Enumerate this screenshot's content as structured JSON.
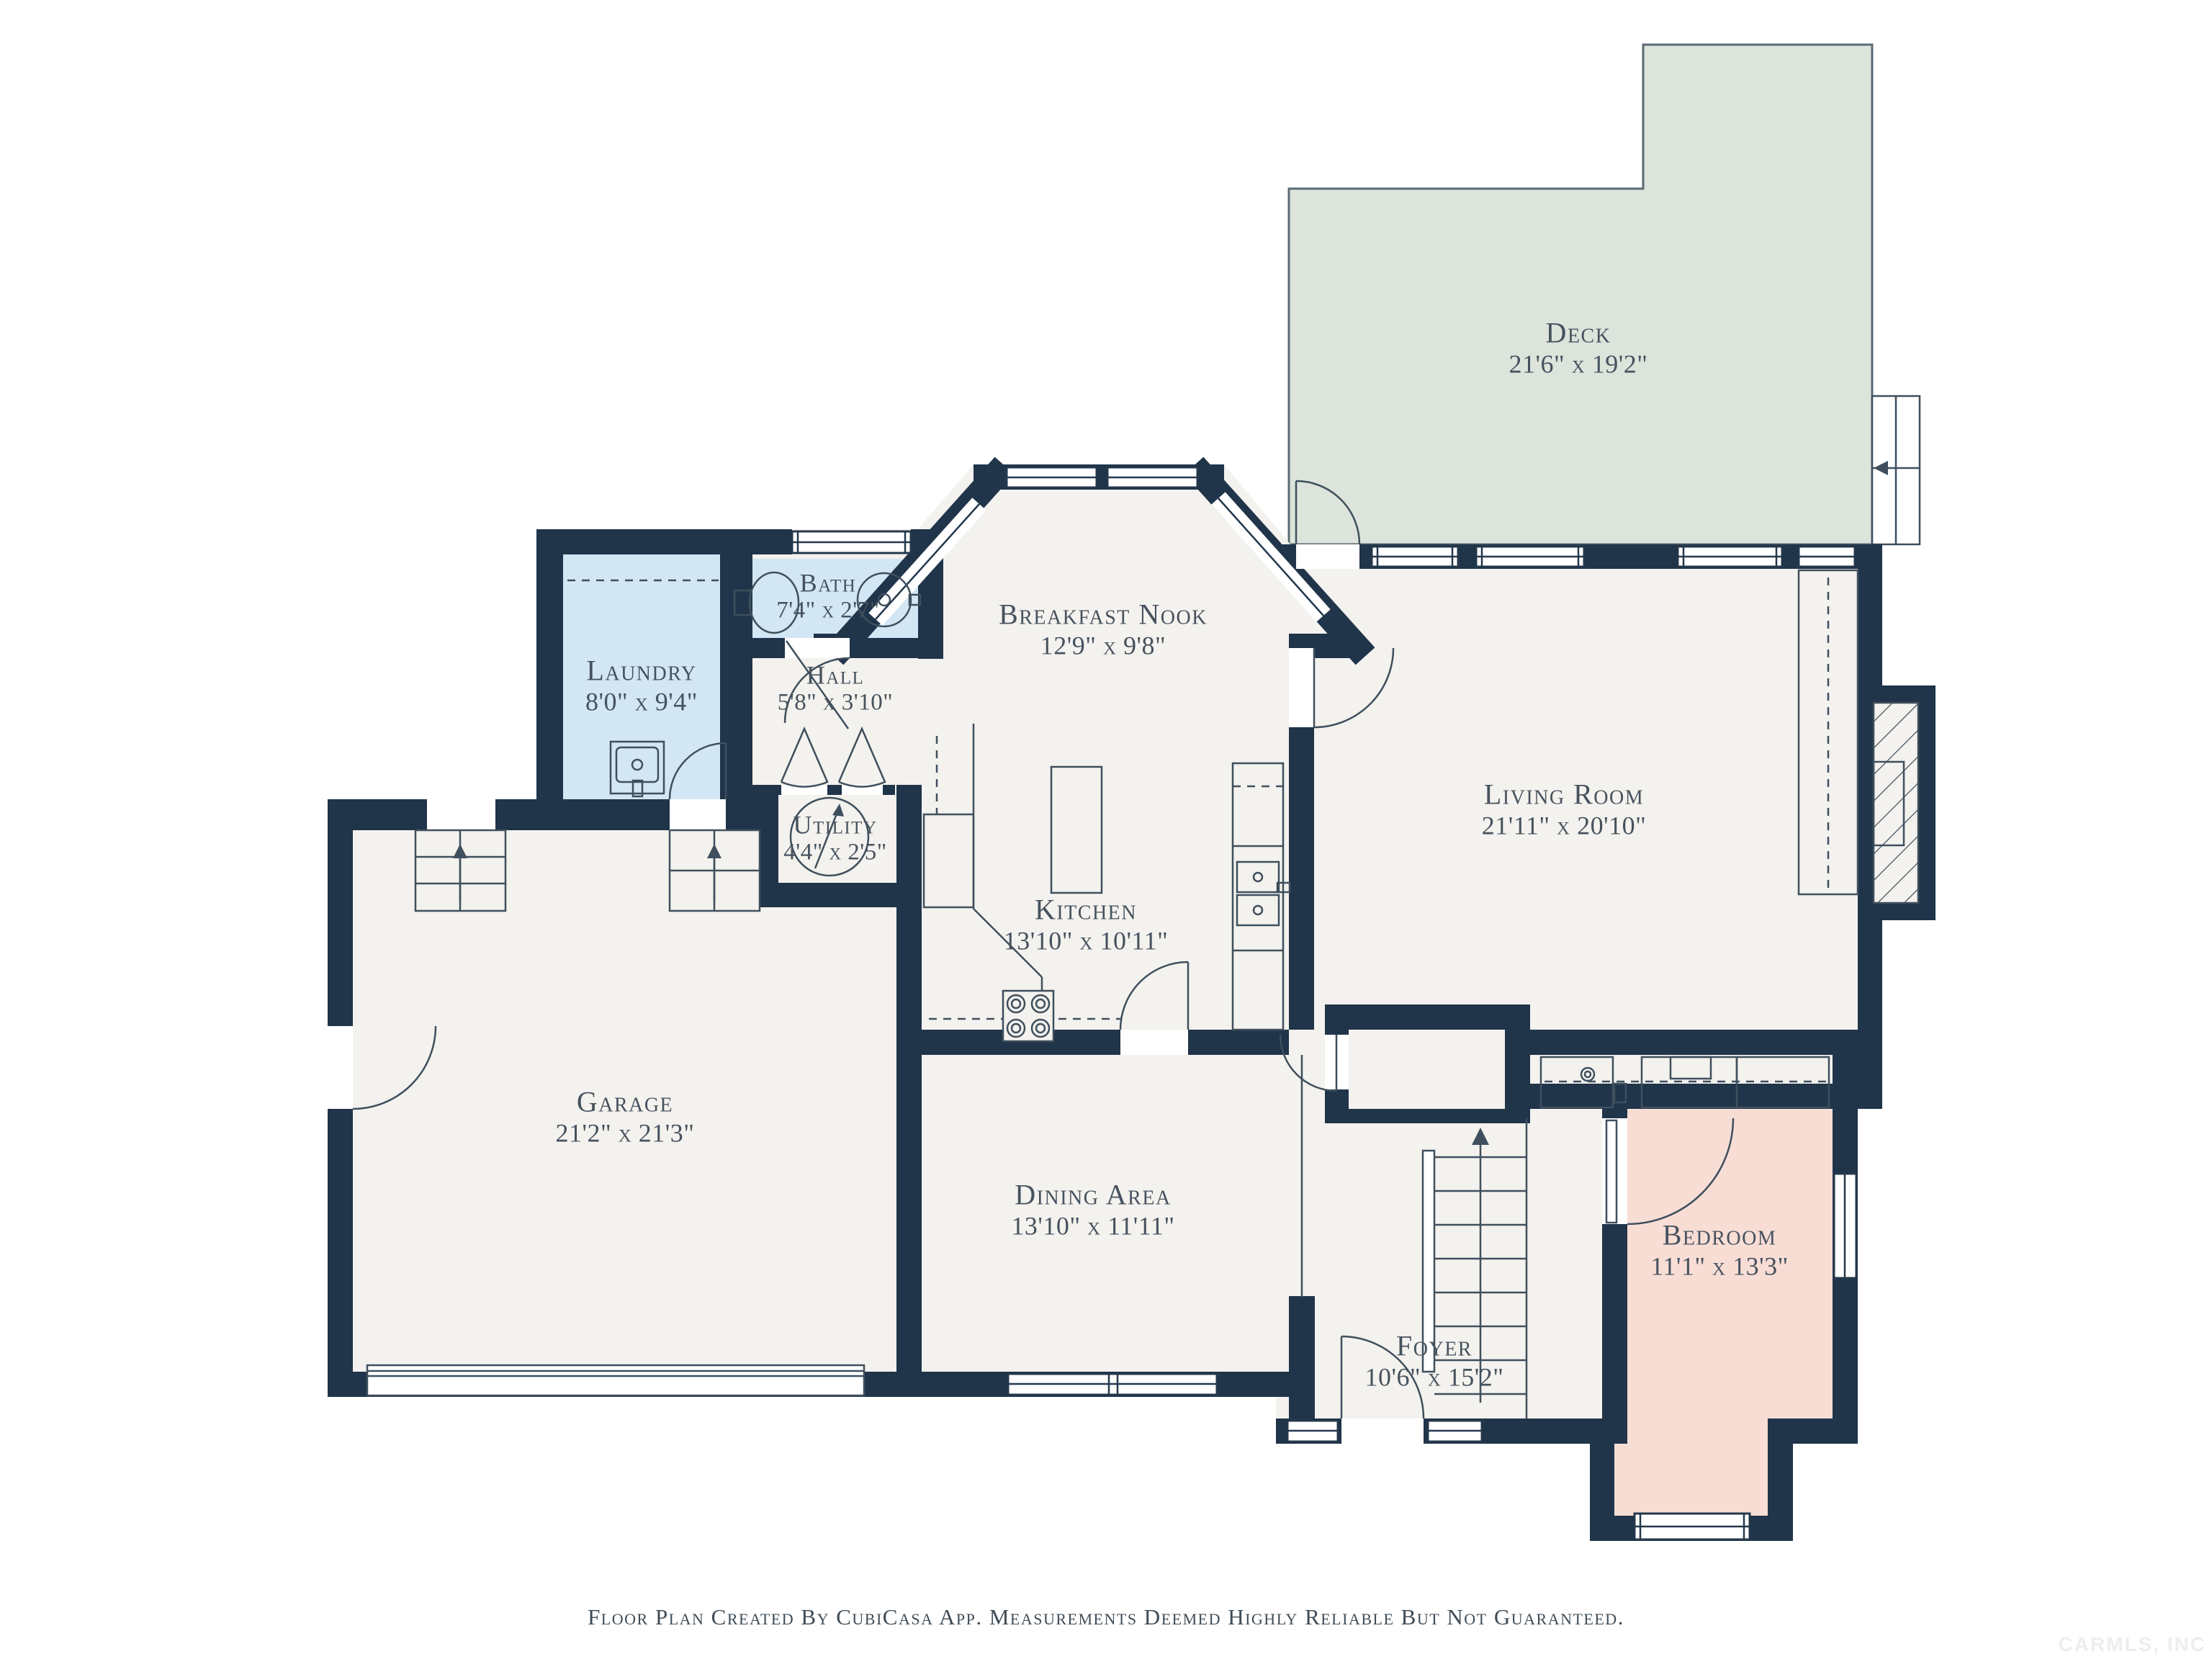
{
  "plan": {
    "source_note": "Floor Plan Created By CubiCasa App. Measurements Deemed Highly Reliable But Not Guaranteed.",
    "watermark": "CARMLS, INC"
  },
  "rooms": [
    {
      "id": "deck",
      "name": "Deck",
      "dims": "21'6\" x 19'2\""
    },
    {
      "id": "bath",
      "name": "Bath",
      "dims": "7'4\" x 2'7\""
    },
    {
      "id": "breakfast-nook",
      "name": "Breakfast Nook",
      "dims": "12'9\" x 9'8\""
    },
    {
      "id": "laundry",
      "name": "Laundry",
      "dims": "8'0\" x 9'4\""
    },
    {
      "id": "hall",
      "name": "Hall",
      "dims": "5'8\" x 3'10\""
    },
    {
      "id": "utility",
      "name": "Utility",
      "dims": "4'4\" x 2'5\""
    },
    {
      "id": "living-room",
      "name": "Living Room",
      "dims": "21'11\" x 20'10\""
    },
    {
      "id": "kitchen",
      "name": "Kitchen",
      "dims": "13'10\" x 10'11\""
    },
    {
      "id": "garage",
      "name": "Garage",
      "dims": "21'2\" x 21'3\""
    },
    {
      "id": "dining-area",
      "name": "Dining Area",
      "dims": "13'10\" x 11'11\""
    },
    {
      "id": "foyer",
      "name": "Foyer",
      "dims": "10'6\" x 15'2\""
    },
    {
      "id": "bedroom",
      "name": "Bedroom",
      "dims": "11'1\" x 13'3\""
    }
  ],
  "colors": {
    "walls": "#20344a",
    "floor": "#f4f2ee",
    "deck": "#dce4db",
    "wet_rooms": "#d3e6f3",
    "bedroom": "#f8ddd5",
    "label_text": "#46525e"
  }
}
